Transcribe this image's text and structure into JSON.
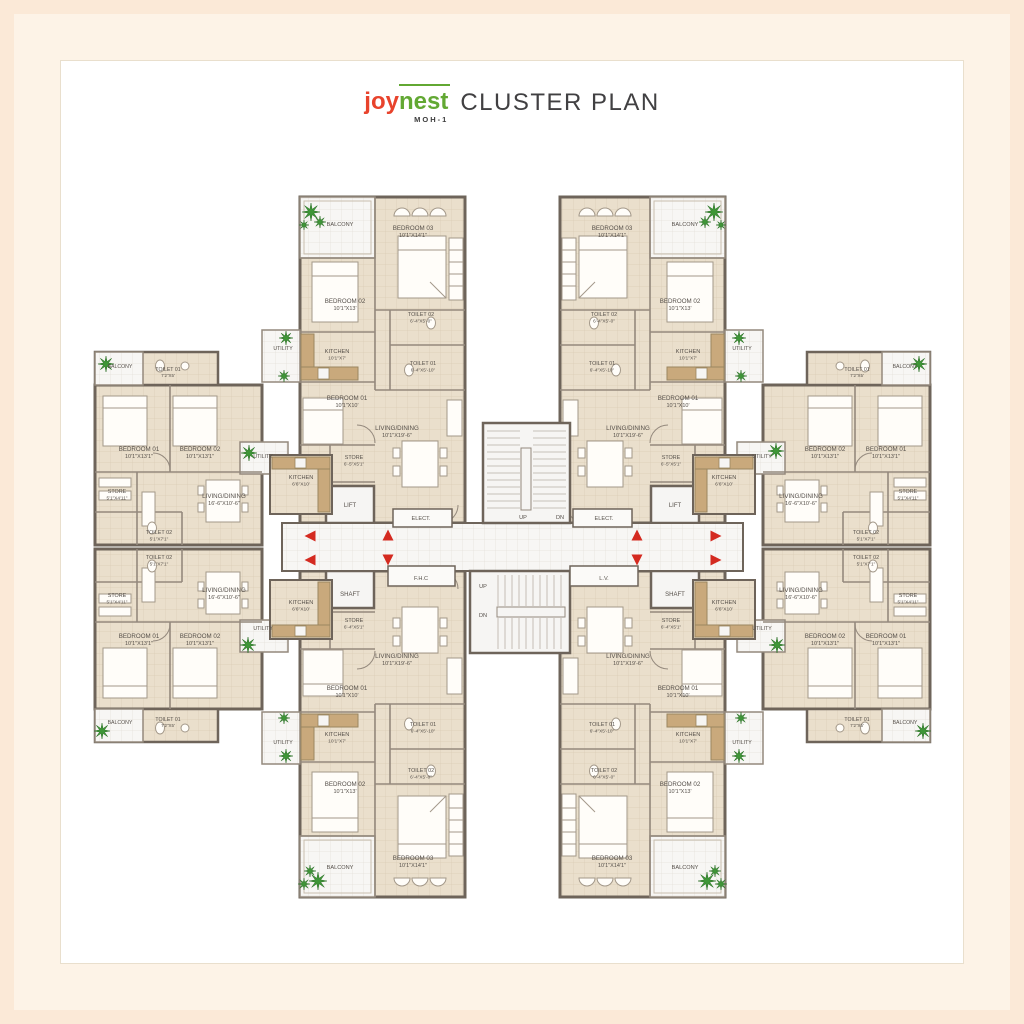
{
  "title": {
    "brand_joy": "joy",
    "brand_nest": "nest",
    "brand_sub": "MOH-1",
    "heading": "CLUSTER PLAN"
  },
  "colors": {
    "frame_outer": "#fbe9d7",
    "frame_inner": "#fdf3e7",
    "panel": "#ffffff",
    "floor_beige": "#eadfcc",
    "grid_beige": "#d9ccb5",
    "floor_white": "#f7f6f4",
    "wall": "#6e645a",
    "wall_thin": "#94897d",
    "counter": "#c9a97c",
    "tree_green": "#3e9637",
    "arrow_red": "#d42a20",
    "label_text": "#56504a",
    "brand_red": "#e8432c",
    "brand_green": "#62a833",
    "heading_gray": "#414042"
  },
  "plan": {
    "labels": [
      {
        "x": 340,
        "y": 226,
        "t": [
          "BALCONY"
        ],
        "s": 5.6
      },
      {
        "x": 413,
        "y": 230,
        "t": [
          "BEDROOM 03",
          "10'1\"X14'1\""
        ]
      },
      {
        "x": 345,
        "y": 303,
        "t": [
          "BEDROOM 02",
          "10'1\"X13'"
        ]
      },
      {
        "x": 421,
        "y": 316,
        "t": [
          "TOILET 02",
          "6'-4\"X5'-0\""
        ],
        "s": 5.4
      },
      {
        "x": 283,
        "y": 350,
        "t": [
          "UTILITY"
        ],
        "s": 5.2
      },
      {
        "x": 337,
        "y": 353,
        "t": [
          "KITCHEN",
          "10'1\"X7'"
        ],
        "s": 5.6
      },
      {
        "x": 423,
        "y": 365,
        "t": [
          "TOILET 01",
          "6'-4\"X5'-10\""
        ],
        "s": 5.4
      },
      {
        "x": 347,
        "y": 400,
        "t": [
          "BEDROOM 01",
          "10'1\"X10'"
        ]
      },
      {
        "x": 397,
        "y": 430,
        "t": [
          "LIVING/DINING",
          "10'1\"X19'-6\""
        ]
      },
      {
        "x": 354,
        "y": 459,
        "t": [
          "STORE",
          "6'-5\"X5'1\""
        ],
        "s": 5.4
      },
      {
        "x": 350,
        "y": 507,
        "t": [
          "LIFT"
        ],
        "s": 6
      },
      {
        "x": 421,
        "y": 520,
        "t": [
          "ELECT."
        ],
        "s": 5.6
      },
      {
        "x": 685,
        "y": 226,
        "t": [
          "BALCONY"
        ],
        "s": 5.6
      },
      {
        "x": 612,
        "y": 230,
        "t": [
          "BEDROOM 03",
          "10'1\"X14'1\""
        ]
      },
      {
        "x": 680,
        "y": 303,
        "t": [
          "BEDROOM 02",
          "10'1\"X13'"
        ]
      },
      {
        "x": 604,
        "y": 316,
        "t": [
          "TOILET 02",
          "6'-4\"X5'-0\""
        ],
        "s": 5.4
      },
      {
        "x": 742,
        "y": 350,
        "t": [
          "UTILITY"
        ],
        "s": 5.2
      },
      {
        "x": 688,
        "y": 353,
        "t": [
          "KITCHEN",
          "10'1\"X7'"
        ],
        "s": 5.6
      },
      {
        "x": 602,
        "y": 365,
        "t": [
          "TOILET 01",
          "6'-4\"X5'-10\""
        ],
        "s": 5.4
      },
      {
        "x": 678,
        "y": 400,
        "t": [
          "BEDROOM 01",
          "10'1\"X10'"
        ]
      },
      {
        "x": 628,
        "y": 430,
        "t": [
          "LIVING/DINING",
          "10'1\"X19'-6\""
        ]
      },
      {
        "x": 671,
        "y": 459,
        "t": [
          "STORE",
          "6'-5\"X5'1\""
        ],
        "s": 5.4
      },
      {
        "x": 675,
        "y": 507,
        "t": [
          "LIFT"
        ],
        "s": 6
      },
      {
        "x": 604,
        "y": 520,
        "t": [
          "ELECT."
        ],
        "s": 5.6
      },
      {
        "x": 350,
        "y": 596,
        "t": [
          "SHAFT"
        ],
        "s": 6
      },
      {
        "x": 354,
        "y": 622,
        "t": [
          "STORE",
          "6'-4\"X5'1\""
        ],
        "s": 5.4
      },
      {
        "x": 397,
        "y": 658,
        "t": [
          "LIVING/DINING",
          "10'1\"X19'-6\""
        ]
      },
      {
        "x": 347,
        "y": 690,
        "t": [
          "BEDROOM 01",
          "10'1\"X10'"
        ]
      },
      {
        "x": 423,
        "y": 726,
        "t": [
          "TOILET 01",
          "6'-4\"X5'-10\""
        ],
        "s": 5.4
      },
      {
        "x": 337,
        "y": 736,
        "t": [
          "KITCHEN",
          "10'1\"X7'"
        ],
        "s": 5.6
      },
      {
        "x": 283,
        "y": 744,
        "t": [
          "UTILITY"
        ],
        "s": 5.2
      },
      {
        "x": 421,
        "y": 772,
        "t": [
          "TOILET 02",
          "6'-4\"X5'-0\""
        ],
        "s": 5.4
      },
      {
        "x": 345,
        "y": 786,
        "t": [
          "BEDROOM 02",
          "10'1\"X13'"
        ]
      },
      {
        "x": 413,
        "y": 860,
        "t": [
          "BEDROOM 03",
          "10'1\"X14'1\""
        ]
      },
      {
        "x": 340,
        "y": 869,
        "t": [
          "BALCONY"
        ],
        "s": 5.6
      },
      {
        "x": 675,
        "y": 596,
        "t": [
          "SHAFT"
        ],
        "s": 6
      },
      {
        "x": 671,
        "y": 622,
        "t": [
          "STORE",
          "6'-4\"X5'1\""
        ],
        "s": 5.4
      },
      {
        "x": 628,
        "y": 658,
        "t": [
          "LIVING/DINING",
          "10'1\"X19'-6\""
        ]
      },
      {
        "x": 678,
        "y": 690,
        "t": [
          "BEDROOM 01",
          "10'1\"X10'"
        ]
      },
      {
        "x": 602,
        "y": 726,
        "t": [
          "TOILET 01",
          "6'-4\"X5'-10\""
        ],
        "s": 5.4
      },
      {
        "x": 688,
        "y": 736,
        "t": [
          "KITCHEN",
          "10'1\"X7'"
        ],
        "s": 5.6
      },
      {
        "x": 742,
        "y": 744,
        "t": [
          "UTILITY"
        ],
        "s": 5.2
      },
      {
        "x": 604,
        "y": 772,
        "t": [
          "TOILET 02",
          "6'-4\"X5'-0\""
        ],
        "s": 5.4
      },
      {
        "x": 680,
        "y": 786,
        "t": [
          "BEDROOM 02",
          "10'1\"X13'"
        ]
      },
      {
        "x": 612,
        "y": 860,
        "t": [
          "BEDROOM 03",
          "10'1\"X14'1\""
        ]
      },
      {
        "x": 685,
        "y": 869,
        "t": [
          "BALCONY"
        ],
        "s": 5.6
      },
      {
        "x": 120,
        "y": 368,
        "t": [
          "BALCONY"
        ],
        "s": 5.2
      },
      {
        "x": 168,
        "y": 371,
        "t": [
          "TOILET 01",
          "7'2\"X5'"
        ],
        "s": 5.2
      },
      {
        "x": 139,
        "y": 451,
        "t": [
          "BEDROOM 01",
          "10'1\"X13'1\""
        ]
      },
      {
        "x": 200,
        "y": 451,
        "t": [
          "BEDROOM 02",
          "10'1\"X13'1\""
        ]
      },
      {
        "x": 263,
        "y": 458,
        "t": [
          "UTILITY"
        ],
        "s": 5.2
      },
      {
        "x": 117,
        "y": 493,
        "t": [
          "STORE",
          "5'1\"X4'11\""
        ],
        "s": 5.4
      },
      {
        "x": 224,
        "y": 498,
        "t": [
          "LIVING/DINING",
          "16'-6\"X10'-6\""
        ]
      },
      {
        "x": 301,
        "y": 479,
        "t": [
          "KITCHEN",
          "6'6\"X10'"
        ],
        "s": 5.6
      },
      {
        "x": 159,
        "y": 534,
        "t": [
          "TOILET 02",
          "5'1\"X7'1\""
        ],
        "s": 5.4
      },
      {
        "x": 159,
        "y": 559,
        "t": [
          "TOILET 02",
          "5'1\"X7'1\""
        ],
        "s": 5.4
      },
      {
        "x": 117,
        "y": 597,
        "t": [
          "STORE",
          "5'1\"X4'11\""
        ],
        "s": 5.4
      },
      {
        "x": 224,
        "y": 592,
        "t": [
          "LIVING/DINING",
          "16'-6\"X10'-6\""
        ]
      },
      {
        "x": 301,
        "y": 604,
        "t": [
          "KITCHEN",
          "6'6\"X10'"
        ],
        "s": 5.6
      },
      {
        "x": 139,
        "y": 638,
        "t": [
          "BEDROOM 01",
          "10'1\"X13'1\""
        ]
      },
      {
        "x": 200,
        "y": 638,
        "t": [
          "BEDROOM 02",
          "10'1\"X13'1\""
        ]
      },
      {
        "x": 263,
        "y": 630,
        "t": [
          "UTILITY"
        ],
        "s": 5.2
      },
      {
        "x": 168,
        "y": 721,
        "t": [
          "TOILET 01",
          "7'2\"X5'"
        ],
        "s": 5.2
      },
      {
        "x": 120,
        "y": 724,
        "t": [
          "BALCONY"
        ],
        "s": 5.2
      },
      {
        "x": 905,
        "y": 368,
        "t": [
          "BALCONY"
        ],
        "s": 5.2
      },
      {
        "x": 857,
        "y": 371,
        "t": [
          "TOILET 01",
          "7'2\"X5'"
        ],
        "s": 5.2
      },
      {
        "x": 886,
        "y": 451,
        "t": [
          "BEDROOM 01",
          "10'1\"X13'1\""
        ]
      },
      {
        "x": 825,
        "y": 451,
        "t": [
          "BEDROOM 02",
          "10'1\"X13'1\""
        ]
      },
      {
        "x": 762,
        "y": 458,
        "t": [
          "UTILITY"
        ],
        "s": 5.2
      },
      {
        "x": 908,
        "y": 493,
        "t": [
          "STORE",
          "5'1\"X4'11\""
        ],
        "s": 5.4
      },
      {
        "x": 801,
        "y": 498,
        "t": [
          "LIVING/DINING",
          "16'-6\"X10'-6\""
        ]
      },
      {
        "x": 724,
        "y": 479,
        "t": [
          "KITCHEN",
          "6'6\"X10'"
        ],
        "s": 5.6
      },
      {
        "x": 866,
        "y": 534,
        "t": [
          "TOILET 02",
          "5'1\"X7'1\""
        ],
        "s": 5.4
      },
      {
        "x": 866,
        "y": 559,
        "t": [
          "TOILET 02",
          "5'1\"X7'1\""
        ],
        "s": 5.4
      },
      {
        "x": 908,
        "y": 597,
        "t": [
          "STORE",
          "5'1\"X4'11\""
        ],
        "s": 5.4
      },
      {
        "x": 801,
        "y": 592,
        "t": [
          "LIVING/DINING",
          "16'-6\"X10'-6\""
        ]
      },
      {
        "x": 724,
        "y": 604,
        "t": [
          "KITCHEN",
          "6'6\"X10'"
        ],
        "s": 5.6
      },
      {
        "x": 886,
        "y": 638,
        "t": [
          "BEDROOM 01",
          "10'1\"X13'1\""
        ]
      },
      {
        "x": 825,
        "y": 638,
        "t": [
          "BEDROOM 02",
          "10'1\"X13'1\""
        ]
      },
      {
        "x": 762,
        "y": 630,
        "t": [
          "UTILITY"
        ],
        "s": 5.2
      },
      {
        "x": 857,
        "y": 721,
        "t": [
          "TOILET 01",
          "7'2\"X5'"
        ],
        "s": 5.2
      },
      {
        "x": 905,
        "y": 724,
        "t": [
          "BALCONY"
        ],
        "s": 5.2
      },
      {
        "x": 523,
        "y": 519,
        "t": [
          "UP"
        ],
        "s": 5.6
      },
      {
        "x": 560,
        "y": 519,
        "t": [
          "DN"
        ],
        "s": 5.6
      },
      {
        "x": 483,
        "y": 588,
        "t": [
          "UP"
        ],
        "s": 5.6
      },
      {
        "x": 483,
        "y": 617,
        "t": [
          "DN"
        ],
        "s": 5.6
      },
      {
        "x": 421,
        "y": 580,
        "t": [
          "F.H.C"
        ],
        "s": 5.6
      },
      {
        "x": 604,
        "y": 580,
        "t": [
          "L.V."
        ],
        "s": 5.6
      }
    ],
    "arrows": [
      {
        "x": 310,
        "y": 536,
        "d": "left"
      },
      {
        "x": 310,
        "y": 560,
        "d": "left"
      },
      {
        "x": 388,
        "y": 535,
        "d": "up"
      },
      {
        "x": 388,
        "y": 560,
        "d": "down"
      },
      {
        "x": 637,
        "y": 535,
        "d": "up"
      },
      {
        "x": 637,
        "y": 560,
        "d": "down"
      },
      {
        "x": 716,
        "y": 536,
        "d": "right"
      },
      {
        "x": 716,
        "y": 560,
        "d": "right"
      }
    ],
    "trees": [
      {
        "x": 311,
        "y": 212,
        "r": 9
      },
      {
        "x": 320,
        "y": 222,
        "r": 6
      },
      {
        "x": 304,
        "y": 225,
        "r": 5
      },
      {
        "x": 286,
        "y": 338,
        "r": 7
      },
      {
        "x": 284,
        "y": 376,
        "r": 6
      },
      {
        "x": 106,
        "y": 364,
        "r": 8
      },
      {
        "x": 249,
        "y": 453,
        "r": 8
      },
      {
        "x": 248,
        "y": 645,
        "r": 8
      },
      {
        "x": 102,
        "y": 731,
        "r": 8
      },
      {
        "x": 714,
        "y": 212,
        "r": 9
      },
      {
        "x": 705,
        "y": 222,
        "r": 6
      },
      {
        "x": 721,
        "y": 225,
        "r": 5
      },
      {
        "x": 739,
        "y": 338,
        "r": 7
      },
      {
        "x": 741,
        "y": 376,
        "r": 6
      },
      {
        "x": 919,
        "y": 364,
        "r": 8
      },
      {
        "x": 776,
        "y": 451,
        "r": 8
      },
      {
        "x": 777,
        "y": 645,
        "r": 8
      },
      {
        "x": 923,
        "y": 731,
        "r": 8
      },
      {
        "x": 310,
        "y": 871,
        "r": 6
      },
      {
        "x": 318,
        "y": 881,
        "r": 9
      },
      {
        "x": 304,
        "y": 884,
        "r": 6
      },
      {
        "x": 286,
        "y": 756,
        "r": 7
      },
      {
        "x": 284,
        "y": 718,
        "r": 6
      },
      {
        "x": 715,
        "y": 871,
        "r": 6
      },
      {
        "x": 707,
        "y": 881,
        "r": 9
      },
      {
        "x": 721,
        "y": 884,
        "r": 6
      },
      {
        "x": 739,
        "y": 756,
        "r": 7
      },
      {
        "x": 741,
        "y": 718,
        "r": 6
      }
    ]
  }
}
